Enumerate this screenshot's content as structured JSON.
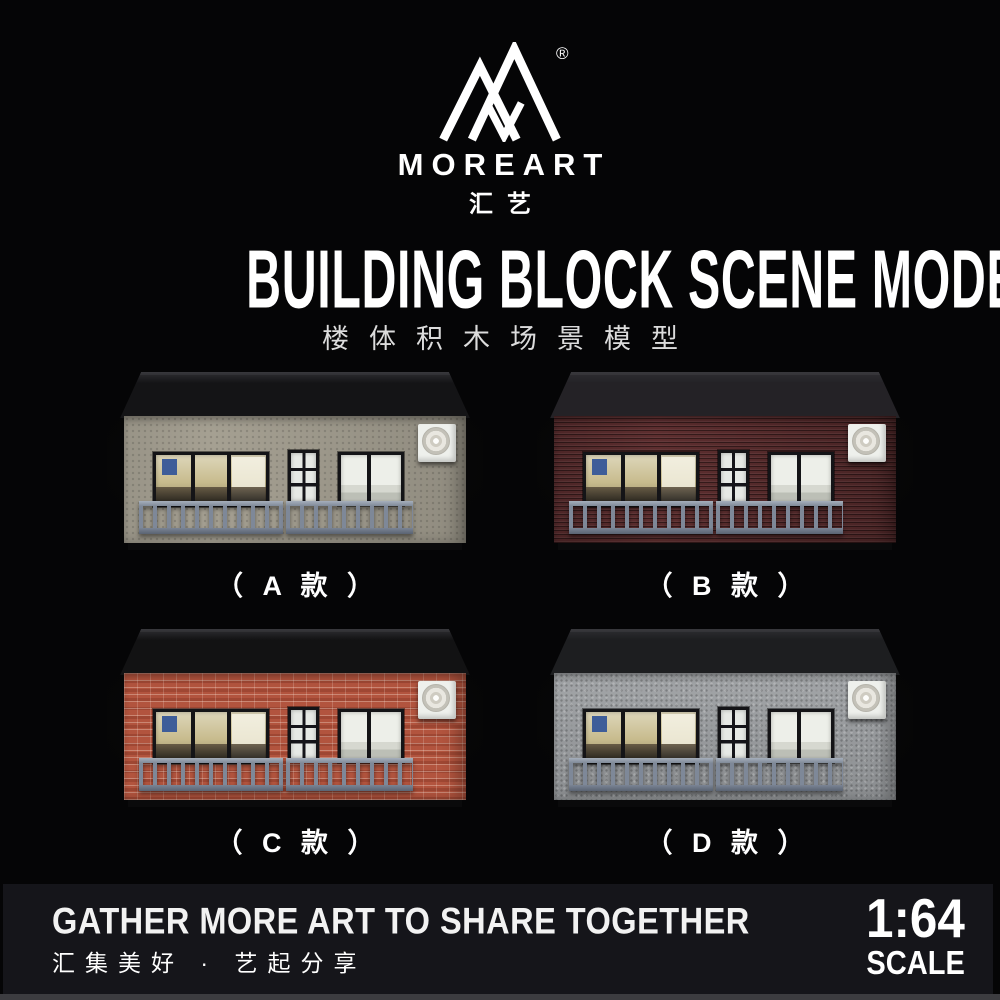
{
  "brand": {
    "name": "MOREART",
    "name_cn": "汇艺",
    "registered_mark": "®",
    "logo": "moreart-mountain-monogram"
  },
  "title": {
    "en": "BUILDING BLOCK SCENE MODEL",
    "cn": "楼体积木场景模型"
  },
  "products": [
    {
      "id": "A",
      "label": "（ A 款 ）",
      "style": "plain-beige",
      "material": "beige stucco wall",
      "wall_color": "#a5a092",
      "roof_color": "#141416"
    },
    {
      "id": "B",
      "label": "（ B 款 ）",
      "style": "dark-red-brick",
      "material": "dark red brick wall",
      "wall_color": "#5d2e2f",
      "roof_color": "#242226"
    },
    {
      "id": "C",
      "label": "（ C 款 ）",
      "style": "red-brick",
      "material": "red brick wall",
      "wall_color": "#b2543e",
      "roof_color": "#121213"
    },
    {
      "id": "D",
      "label": "（ D 款 ）",
      "style": "gray-concrete",
      "material": "gray concrete wall",
      "wall_color": "#9b9ea1",
      "roof_color": "#1d1e20"
    }
  ],
  "footer": {
    "slogan_en": "GATHER MORE ART TO SHARE TOGETHER",
    "slogan_cn": "汇集美好 · 艺起分享",
    "scale_ratio": "1:64",
    "scale_label": "SCALE"
  },
  "colors": {
    "background": "#050506",
    "footer_bar": "#15151a",
    "bottom_strip": "#3c3c40",
    "text": "#ffffff",
    "railing": "#7e8898",
    "window_frame": "#141417",
    "ac_unit": "#eef0ec"
  }
}
